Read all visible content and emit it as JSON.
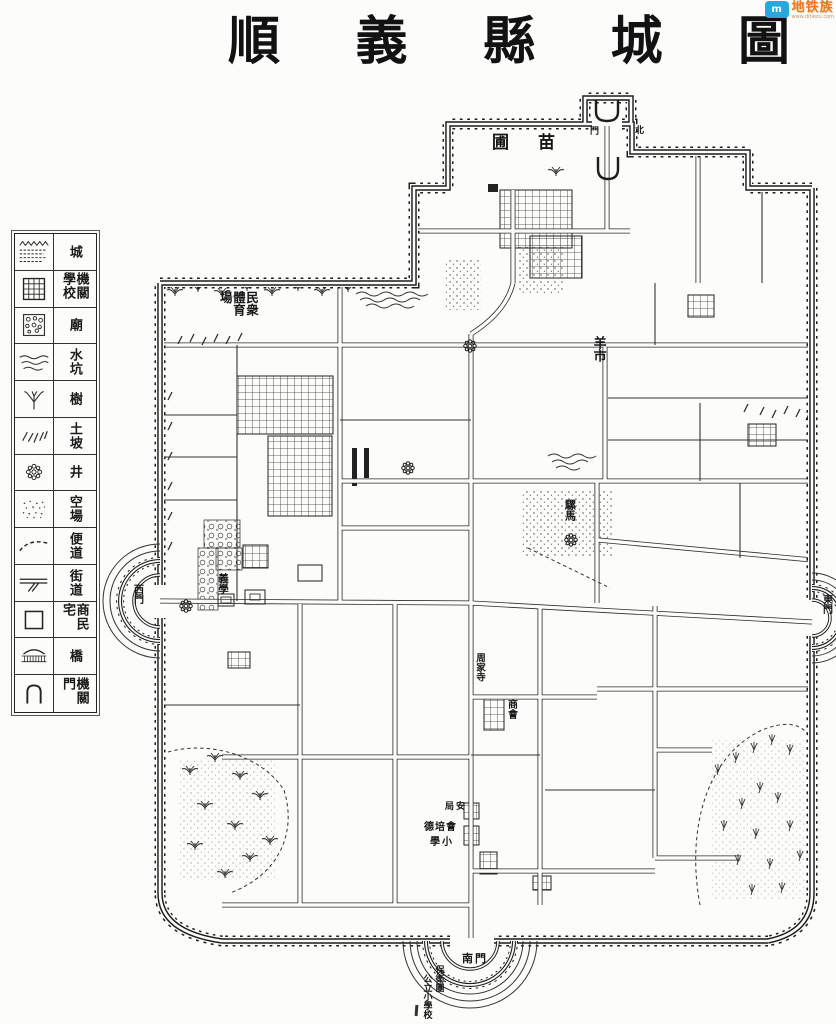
{
  "watermark": {
    "brand": "地铁族",
    "url": "www.ditiezu.com",
    "icon": "map-logo-icon"
  },
  "title": {
    "chars": [
      "順",
      "義",
      "縣",
      "城",
      "圖"
    ]
  },
  "legend": {
    "rows": [
      {
        "symbol": "city-wall",
        "label": "城"
      },
      {
        "symbol": "institution-school",
        "label": "機關學校"
      },
      {
        "symbol": "temple",
        "label": "廟"
      },
      {
        "symbol": "water-pit",
        "label": "水坑"
      },
      {
        "symbol": "tree",
        "label": "樹"
      },
      {
        "symbol": "earth-slope",
        "label": "土坡"
      },
      {
        "symbol": "well",
        "label": "井"
      },
      {
        "symbol": "open-ground",
        "label": "空場"
      },
      {
        "symbol": "byway",
        "label": "便道"
      },
      {
        "symbol": "street",
        "label": "街道"
      },
      {
        "symbol": "residence",
        "label": "商民宅"
      },
      {
        "symbol": "bridge",
        "label": "橋"
      },
      {
        "symbol": "office-gate",
        "label": "機關門"
      }
    ]
  },
  "map": {
    "labels": {
      "nursery": "圃　苗",
      "north_gate_left": "門",
      "north_gate_right": "北",
      "sports_ground": "民衆體育場",
      "sheep_market": "羊市",
      "west_gate": "西門",
      "east_gate": "東門",
      "south_gate": "南門",
      "mule_horse_market": "騾馬",
      "temple_street": "周家寺",
      "chamber_of_commerce": "商會",
      "police_bureau": "局安",
      "school_row1": "德培會",
      "school_row2": "學小",
      "militia": "保衛團",
      "public_primary_school": "公立小學校",
      "charity_school": "義學"
    }
  }
}
